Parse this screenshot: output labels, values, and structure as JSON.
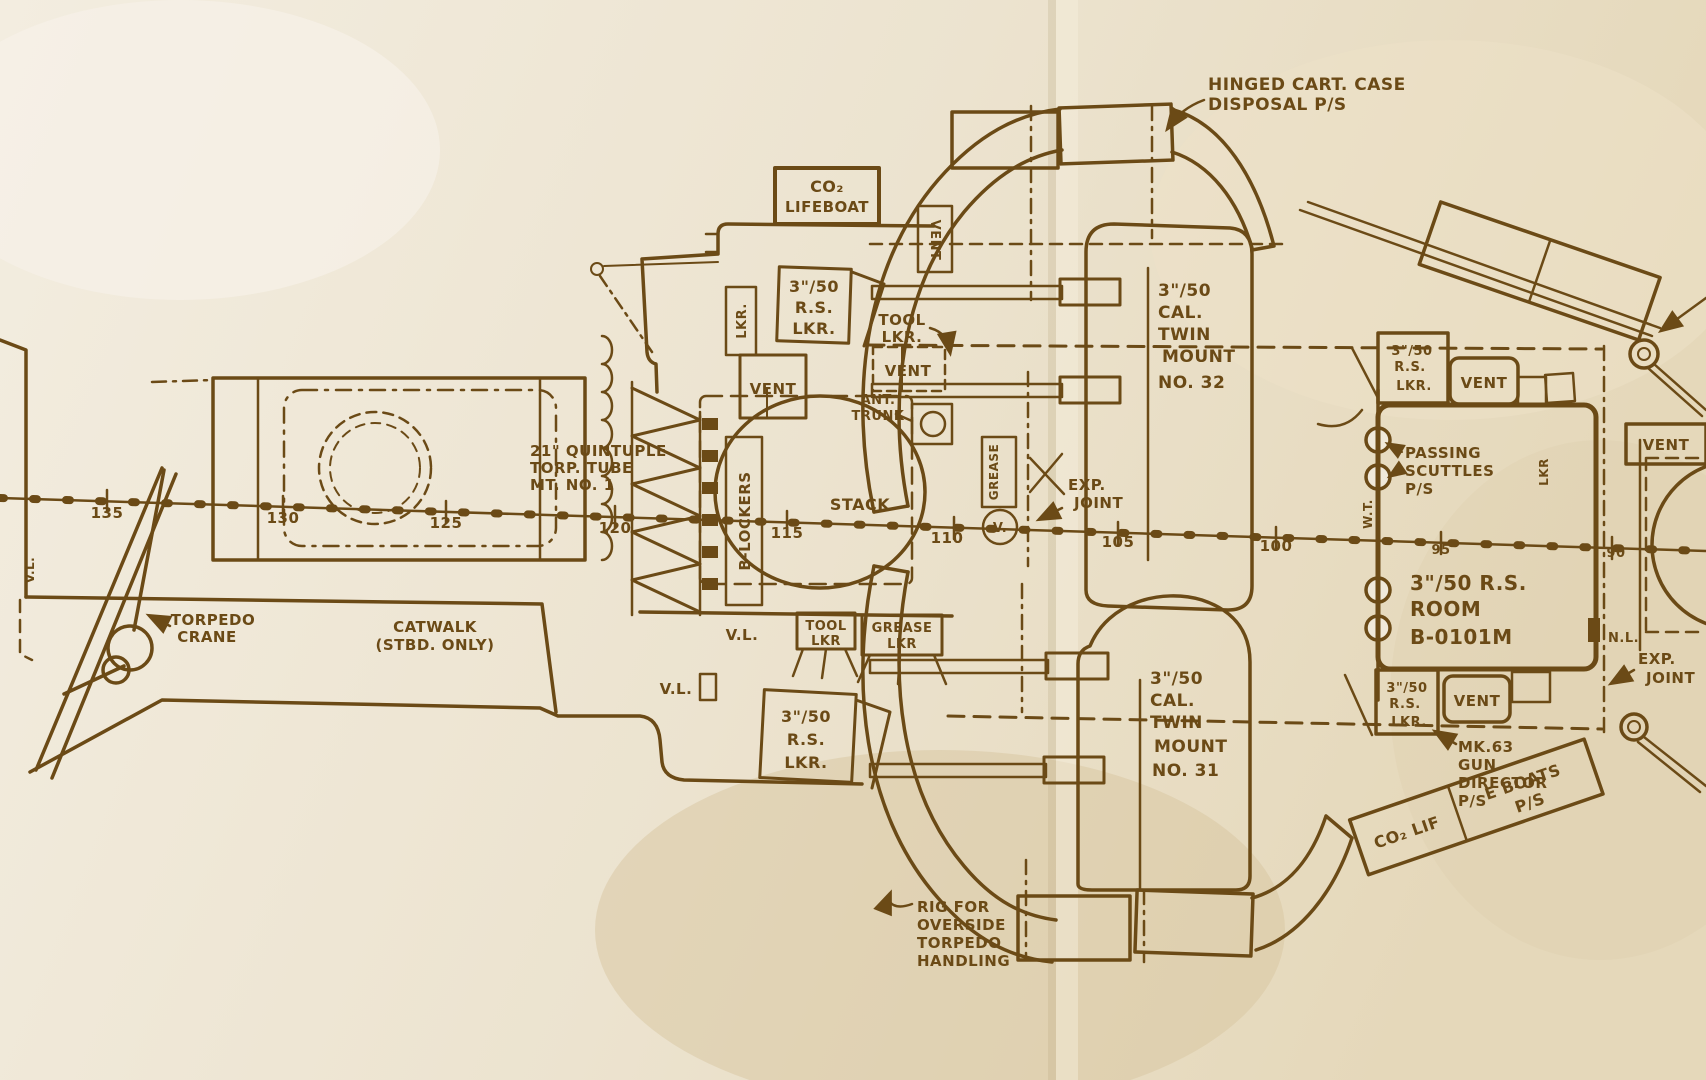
{
  "colors": {
    "ink": "#6b4a16",
    "paper": "#f0e9da",
    "stain": "#d8c6a1"
  },
  "frames": [
    "135",
    "130",
    "125",
    "120",
    "115",
    "110",
    "105",
    "100",
    "95",
    "90"
  ],
  "labels": {
    "hinged_cart_1": "HINGED CART. CASE",
    "hinged_cart_2": "DISPOSAL P/S",
    "co2_1": "CO₂",
    "co2_2": "LIFEBOAT",
    "lkr": "LKR.",
    "lkr_plain": "LKR",
    "vent": "VENT",
    "tool": "TOOL",
    "grease": "GREASE",
    "rs_3_50": "3\"/50",
    "rs": "R.S.",
    "ant_1": "ANT.",
    "ant_2": "TRUNK",
    "torp_1": "21\" QUINTUPLE",
    "torp_2": "TORP. TUBE",
    "torp_3": "MT. NO. 1",
    "b_lockers": "B-LOCKERS",
    "stack": "STACK",
    "exp_1": "EXP.",
    "exp_2": "JOINT",
    "v": "V.",
    "vl": "V.L.",
    "nl": "N.L.",
    "wt": "W.T.",
    "cal": "CAL.",
    "twin": "TWIN",
    "mount": "MOUNT",
    "no32": "NO. 32",
    "no31": "NO. 31",
    "torpedo": "TORPEDO",
    "crane": "CRANE",
    "catwalk_1": "CATWALK",
    "catwalk_2": "(STBD. ONLY)",
    "passing_1": "PASSING",
    "passing_2": "SCUTTLES",
    "ps": "P/S",
    "room_1": "3\"/50 R.S.",
    "room_2": "ROOM",
    "room_3": "B-0101M",
    "mk63_1": "MK.63",
    "mk63_2": "GUN",
    "mk63_3": "DIRECTOR",
    "boats_1": "CO₂ LIF",
    "boats_2": "E BOATS",
    "rig_1": "RIG FOR",
    "rig_2": "OVERSIDE",
    "rig_4": "HANDLING"
  }
}
